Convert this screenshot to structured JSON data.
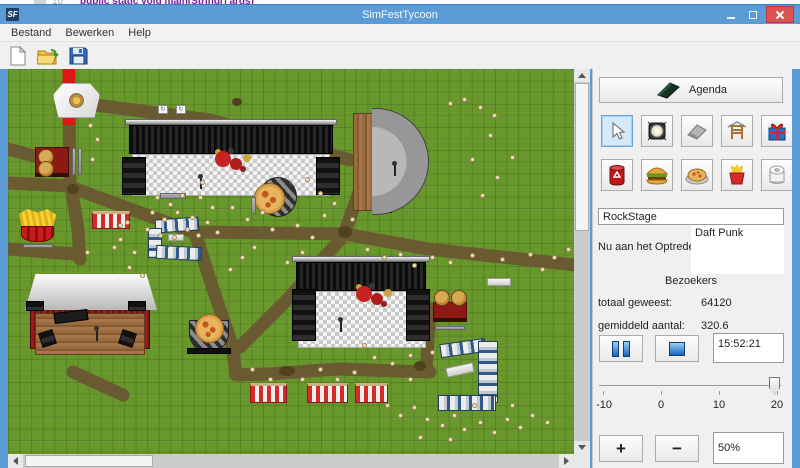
{
  "desktop": {
    "code_line": "public static void main(String[] args)",
    "line_number": "10"
  },
  "window": {
    "title": "SimFestTycoon",
    "app_initials": "SF"
  },
  "menu": {
    "items": [
      "Bestand",
      "Bewerken",
      "Help"
    ]
  },
  "toolbar": {
    "icons": [
      "new-file",
      "open-folder",
      "save-floppy"
    ]
  },
  "sidebar": {
    "agenda_label": "Agenda",
    "tools_row1": [
      "select-cursor",
      "stage-light",
      "road",
      "stage-scaffold",
      "gift"
    ],
    "tools_row2": [
      "trash-can",
      "hamburger",
      "pizza",
      "fries",
      "toilet-roll"
    ],
    "stage_name_value": "RockStage",
    "now_playing_label": "Nu aan het Optreden:",
    "now_playing_value": "Daft Punk",
    "visitors_header": "Bezoekers",
    "total_label": "totaal geweest:",
    "total_value": "64120",
    "average_label": "gemiddeld aantal:",
    "average_value": "320.6",
    "clock_value": "15:52:21",
    "slider": {
      "ticks": [
        "-10",
        "0",
        "10",
        "20"
      ],
      "value": 20
    },
    "zoom_in_label": "+",
    "zoom_out_label": "−",
    "zoom_value": "50%"
  },
  "map": {
    "people": [
      [
        147,
        126
      ],
      [
        160,
        133
      ],
      [
        172,
        124
      ],
      [
        142,
        141
      ],
      [
        154,
        148
      ],
      [
        167,
        141
      ],
      [
        182,
        146
      ],
      [
        137,
        158
      ],
      [
        150,
        164
      ],
      [
        164,
        166
      ],
      [
        177,
        158
      ],
      [
        188,
        164
      ],
      [
        197,
        151
      ],
      [
        202,
        136
      ],
      [
        190,
        126
      ],
      [
        207,
        161
      ],
      [
        117,
        151
      ],
      [
        110,
        168
      ],
      [
        124,
        181
      ],
      [
        119,
        196
      ],
      [
        132,
        204
      ],
      [
        192,
        111
      ],
      [
        222,
        136
      ],
      [
        237,
        148
      ],
      [
        252,
        141
      ],
      [
        262,
        158
      ],
      [
        287,
        154
      ],
      [
        302,
        166
      ],
      [
        314,
        144
      ],
      [
        324,
        132
      ],
      [
        342,
        148
      ],
      [
        310,
        122
      ],
      [
        297,
        108
      ],
      [
        357,
        178
      ],
      [
        374,
        186
      ],
      [
        390,
        183
      ],
      [
        404,
        194
      ],
      [
        422,
        186
      ],
      [
        440,
        191
      ],
      [
        462,
        184
      ],
      [
        492,
        188
      ],
      [
        520,
        183
      ],
      [
        544,
        186
      ],
      [
        558,
        178
      ],
      [
        532,
        198
      ],
      [
        364,
        286
      ],
      [
        382,
        292
      ],
      [
        400,
        284
      ],
      [
        422,
        281
      ],
      [
        354,
        274
      ],
      [
        377,
        334
      ],
      [
        390,
        344
      ],
      [
        404,
        336
      ],
      [
        417,
        348
      ],
      [
        432,
        354
      ],
      [
        444,
        344
      ],
      [
        454,
        358
      ],
      [
        470,
        351
      ],
      [
        484,
        361
      ],
      [
        497,
        348
      ],
      [
        510,
        356
      ],
      [
        522,
        344
      ],
      [
        537,
        351
      ],
      [
        464,
        334
      ],
      [
        502,
        334
      ],
      [
        410,
        366
      ],
      [
        440,
        368
      ],
      [
        440,
        32
      ],
      [
        454,
        28
      ],
      [
        470,
        36
      ],
      [
        484,
        44
      ],
      [
        480,
        64
      ],
      [
        462,
        88
      ],
      [
        487,
        106
      ],
      [
        472,
        124
      ],
      [
        502,
        86
      ],
      [
        80,
        54
      ],
      [
        87,
        68
      ],
      [
        82,
        88
      ],
      [
        110,
        154
      ],
      [
        104,
        176
      ],
      [
        77,
        181
      ],
      [
        232,
        186
      ],
      [
        220,
        198
      ],
      [
        244,
        176
      ],
      [
        292,
        181
      ],
      [
        277,
        191
      ],
      [
        242,
        298
      ],
      [
        260,
        308
      ],
      [
        292,
        308
      ],
      [
        310,
        298
      ],
      [
        327,
        308
      ],
      [
        344,
        301
      ],
      [
        400,
        308
      ]
    ]
  }
}
